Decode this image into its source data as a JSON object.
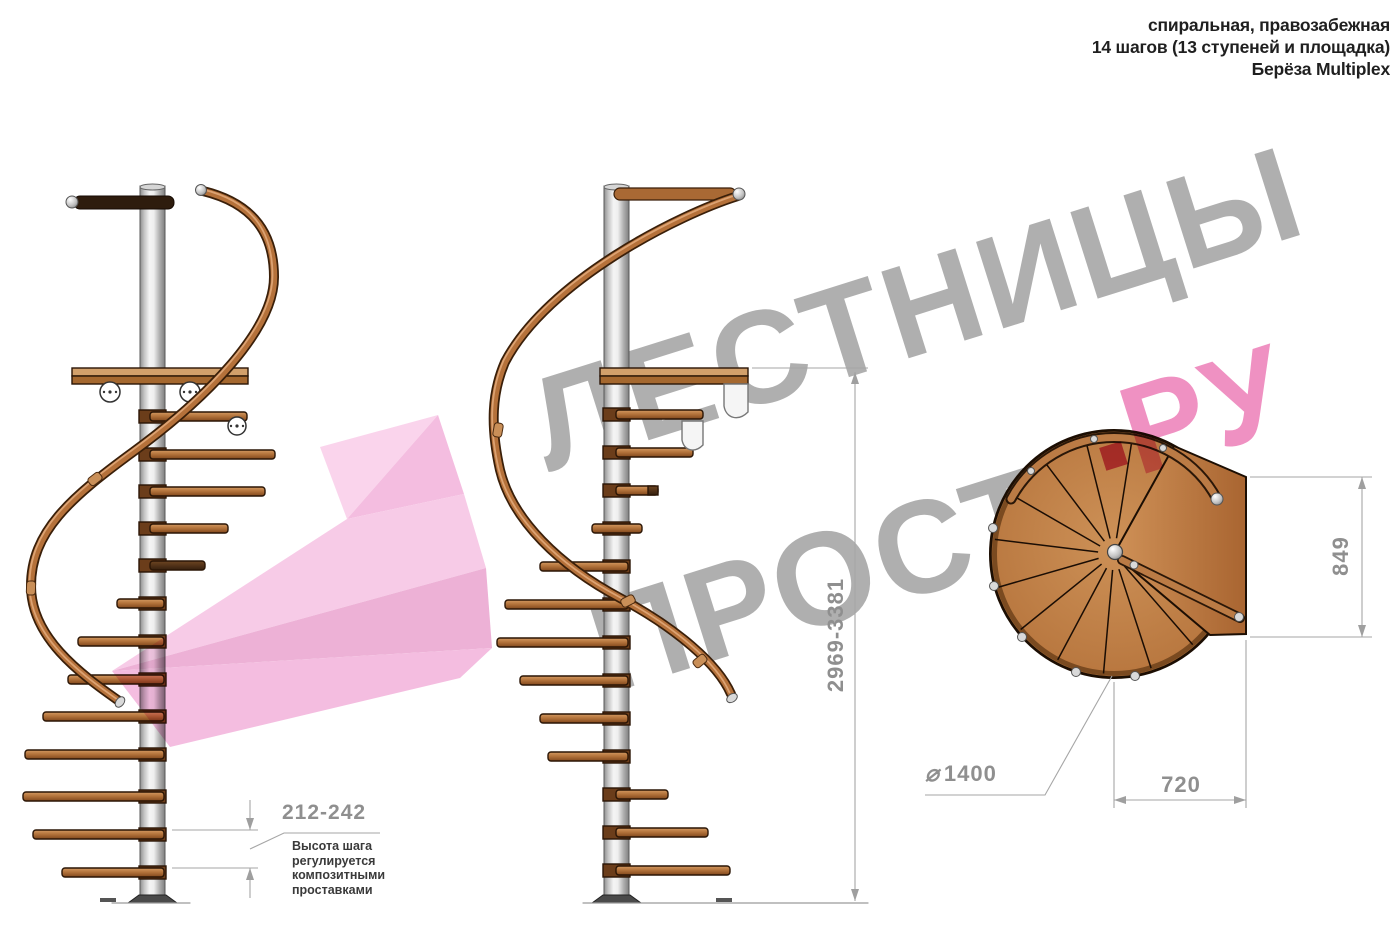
{
  "header": {
    "line1": "спиральная, правозабежная",
    "line2": "14 шагов (13 ступеней и площадка)",
    "line3": "Берёза Multiplex"
  },
  "watermark": {
    "brand_top": "ЛЕСТНИЦЫ",
    "brand_bottom": "ПРОСТО",
    "brand_dot": ".",
    "brand_suffix": "РУ"
  },
  "dimensions": {
    "step_height": "212-242",
    "step_height_note": "Высота шага\nрегулируется\nкомпозитными\nпроставками",
    "total_height": "2969-3381",
    "plan_depth": "849",
    "plan_width": "720",
    "diameter_symbol": "⌀",
    "diameter_value": "1400"
  },
  "colors": {
    "watermark_gray": "#9c9c9c",
    "brand_pink": "#ee85bb",
    "brand_dot_pink": "#d6447a",
    "ribbon_pink": "#f3b2da",
    "wood_mid": "#b4743c",
    "dim_gray": "#8f8f8f",
    "note_gray": "#3a3a3a"
  }
}
